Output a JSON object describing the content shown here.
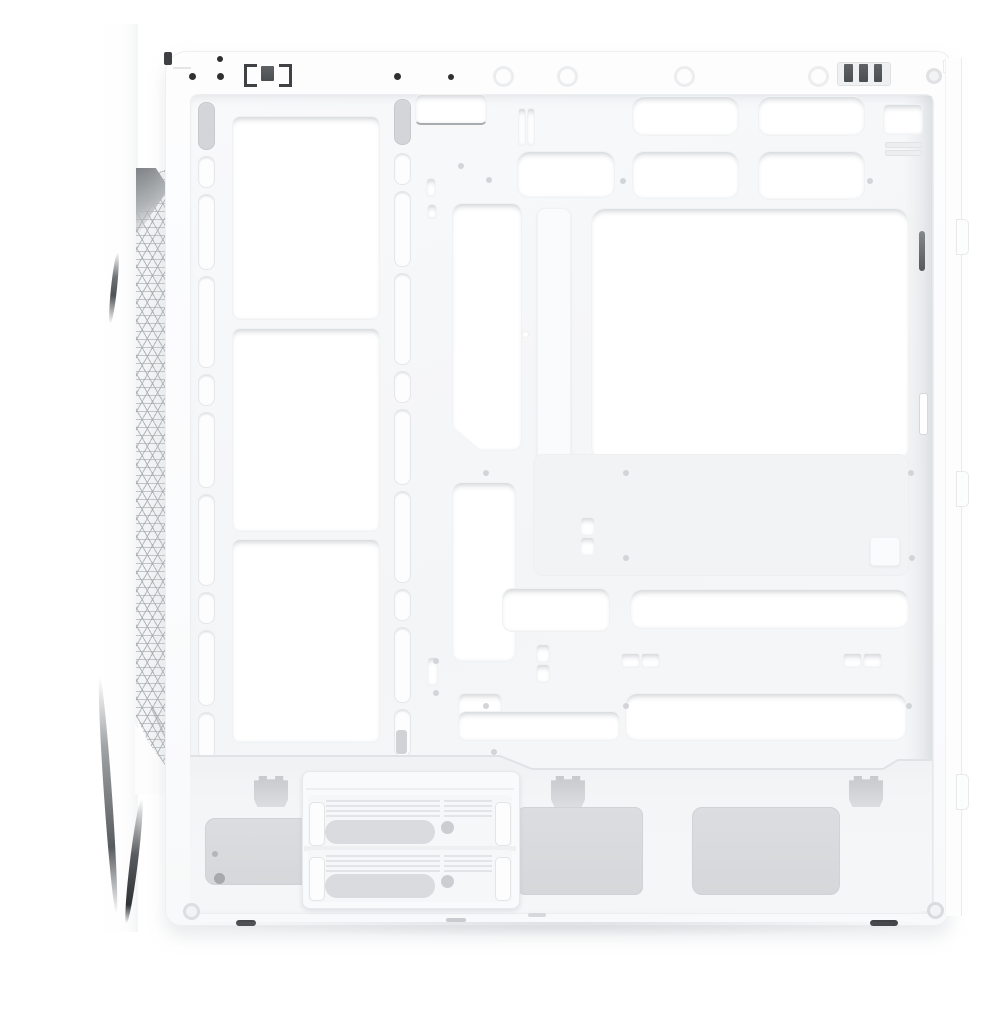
{
  "meta": {
    "subject": "White mid-tower PC case interior, side view with side panel removed",
    "caption": "Empty white ATX chassis: front mesh vent strip on the left, triple fan/radiator mounting bracket, motherboard tray with CPU cooler cutout and cable grommets, PSU shroud with a 2.5-inch drive cage at the bottom",
    "background": "#ffffff"
  },
  "palette": {
    "chassis_white": "#fcfdfd",
    "interior_tint": "#f5f6f8",
    "cutout_white": "#ffffff",
    "recess_gray": "#f2f3f5",
    "vent_panel_gray": "#d8dadd",
    "mesh_line_gray": "#aaadb1",
    "hardware_dark": "#2e3032",
    "slot_dark": "#6a6d70"
  },
  "parts": {
    "front_panel": {
      "name": "front-panel-edge",
      "vent": "triangular perforated mesh strip",
      "mesh_clip_tabs": 4
    },
    "top_rail": {
      "screw_holes": 5,
      "washer_marks": 4,
      "latches": 2,
      "corner_screws": 1
    },
    "fan_bracket": {
      "name": "front fan / radiator mounting bracket",
      "fan_openings": 3,
      "slotted_rails": 2,
      "slots_per_rail": 10
    },
    "motherboard_tray": {
      "cpu_cooler_cutout": 1,
      "top_cable_grommets": 2,
      "mid_cable_grommets": 3,
      "side_cable_cutouts": 2,
      "lower_cable_bar": 1,
      "bottom_cable_grommets": 2,
      "cable_tie_slots": 6,
      "standoff_screw_holes": 15
    },
    "rear_frame": {
      "dark_slot": 1,
      "light_slot": 1,
      "vent_slits": 2,
      "small_cutout": 1,
      "edge_tabs": 3
    },
    "psu_shroud": {
      "name": "power supply chamber",
      "vent_panels": 3,
      "accessory_hook_cutouts": 3
    },
    "drive_cage": {
      "name": "2.5-inch SSD tray cage",
      "trays": 2,
      "thumb_holes": 2
    },
    "base": {
      "corner_screws": 2,
      "foot_marks": 2
    }
  }
}
